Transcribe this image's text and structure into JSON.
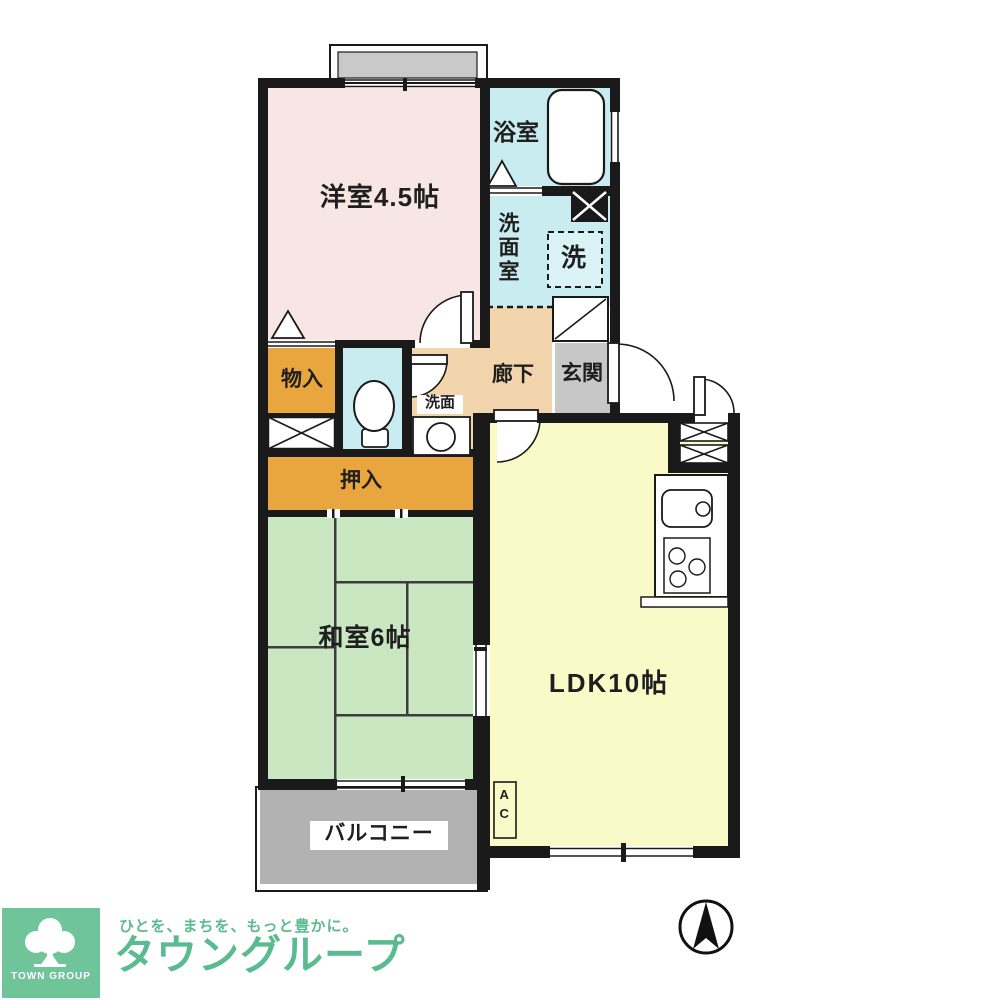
{
  "floorplan": {
    "labels": {
      "western_room": "洋室4.5帖",
      "bath": "浴室",
      "washroom": "洗面室",
      "washer": "洗",
      "hallway": "廊下",
      "entrance": "玄関",
      "storage": "物入",
      "washbasin": "洗面",
      "closet": "押入",
      "japanese_room": "和室6帖",
      "ldk": "LDK10帖",
      "balcony": "バルコニー",
      "ac_unit": "AC"
    },
    "colors": {
      "western_room": "#f8e6e4",
      "wet_area_cyan": "#c9ecf0",
      "washer_box": "#d9f3f6",
      "hallway_peach": "#f3d5ad",
      "entrance_gray": "#c7c7c7",
      "storage_orange": "#e9a63e",
      "japanese_green": "#c9e8c2",
      "ldk_yellow": "#fafac9",
      "balcony_gray": "#b2b2b2",
      "wall_black": "#1a1a1a"
    },
    "compass": "north-arrow"
  },
  "footer": {
    "logo_square_text": "TOWN GROUP",
    "tagline": "ひとを、まちを、もっと豊かに。",
    "brand": "タウングループ",
    "brand_color": "#5bbb90",
    "logo_bg": "#6fc49a"
  }
}
